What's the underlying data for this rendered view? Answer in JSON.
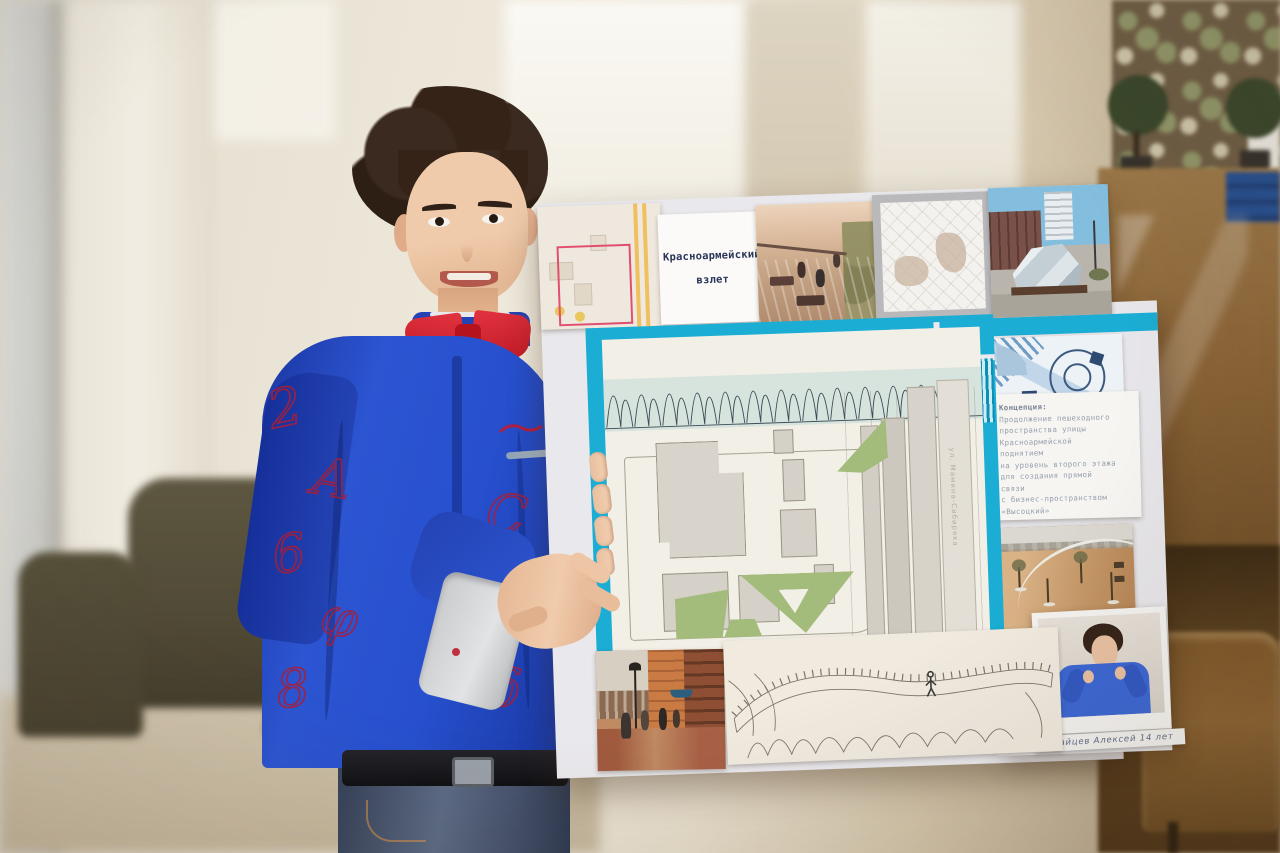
{
  "poster": {
    "title": {
      "line1": "Красноармейский",
      "line2": "взлет"
    },
    "concept": {
      "heading": "Концепция:",
      "lines": [
        "Продолжение пешеходного",
        "пространства улицы",
        "Красноармейской",
        "поднятием",
        "на уровень второго этажа",
        "для создания прямой",
        "связи",
        "с бизнес-пространством",
        "«Высоцкий»"
      ]
    },
    "plan": {
      "street_label": "ул. Мамина-Сибиряка"
    },
    "signature": "Крайцев Алексей 14 лет"
  },
  "boy": {
    "doodles": [
      "2",
      "6",
      "8",
      "A",
      "C",
      "φ",
      "9",
      "δ"
    ]
  },
  "colors": {
    "teal_frame": "#1badd3",
    "poster_backing": "#e9e8ec",
    "plan_paper": "#f2efe7",
    "plan_green": "#a3bc7c",
    "shirt_blue": "#2750ce",
    "bowtie_red": "#d5232e",
    "jeans": "#45516b",
    "wood_cabinet": "#8a6336"
  }
}
